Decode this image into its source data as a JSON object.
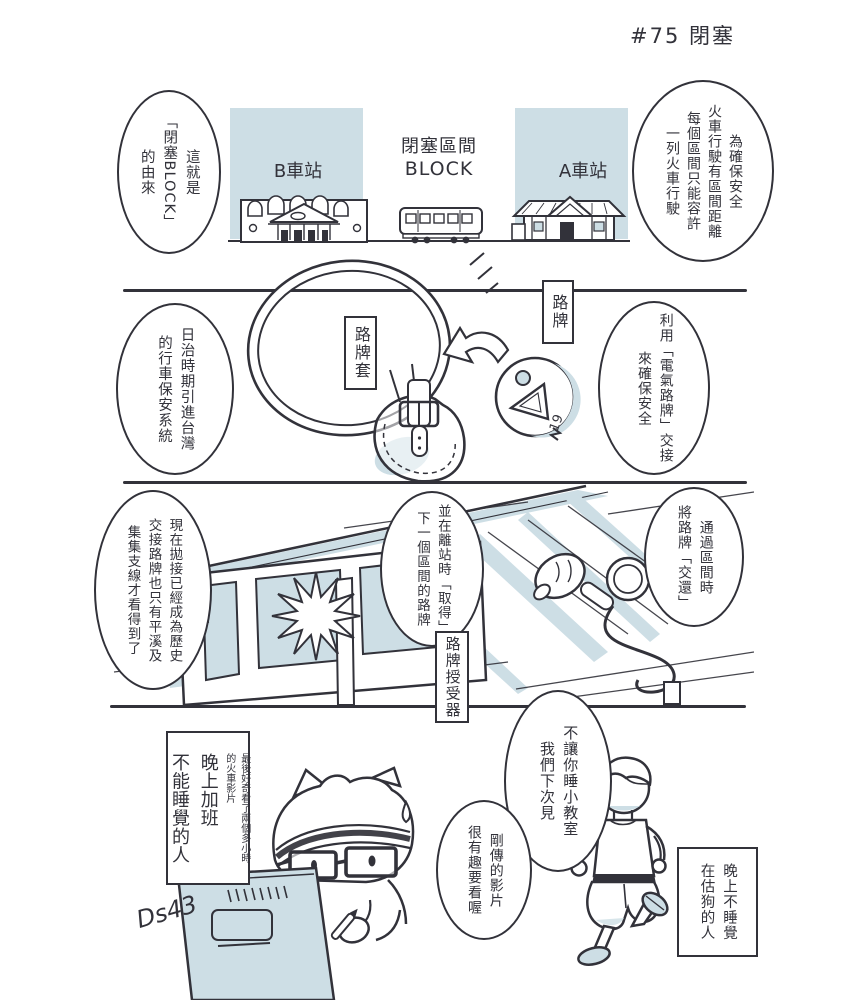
{
  "page": {
    "title": "#75 閉塞"
  },
  "colors": {
    "ink": "#32323a",
    "shade": "#cddee5",
    "paper": "#ffffff"
  },
  "panel1": {
    "bubble_left": "這就是\n「閉塞BLOCK」\n的由來",
    "bubble_right": "為確保安全\n火車行駛有區間距離\n每個區間只能容許\n一列火車行駛",
    "station_b": "B車站",
    "station_a": "A車站",
    "block_label_zh": "閉塞區間",
    "block_label_en": "BLOCK"
  },
  "panel2": {
    "bubble_left": "日治時期引進台灣\n的行車保安系統",
    "bubble_right": "利用「電氣路牌」交接\n來確保安全",
    "tablet_pouch_label": "路牌套",
    "tablet_label": "路牌",
    "token_number": "19"
  },
  "panel3": {
    "bubble_left": "現在拋接已經成為歷史\n交接路牌也只有平溪及\n集集支線才看得到了",
    "bubble_middle": "並在離站時「取得」\n下一個區間的路牌",
    "bubble_right": "通過區間時\n將路牌「交還」",
    "receiver_label": "路牌授受器"
  },
  "panel4": {
    "caption_overtime_main": "晚上加班\n不能睡覺的人",
    "caption_overtime_sub": "最後好奇看了兩個多小時\n的火車影片",
    "bubble_classroom": "不讓你睡小教室\n我們下次見",
    "bubble_video": "剛傳的影片\n很有趣要看喔",
    "caption_googling": "晚上不睡覺\n在估狗的人",
    "signature": "Ds43"
  }
}
